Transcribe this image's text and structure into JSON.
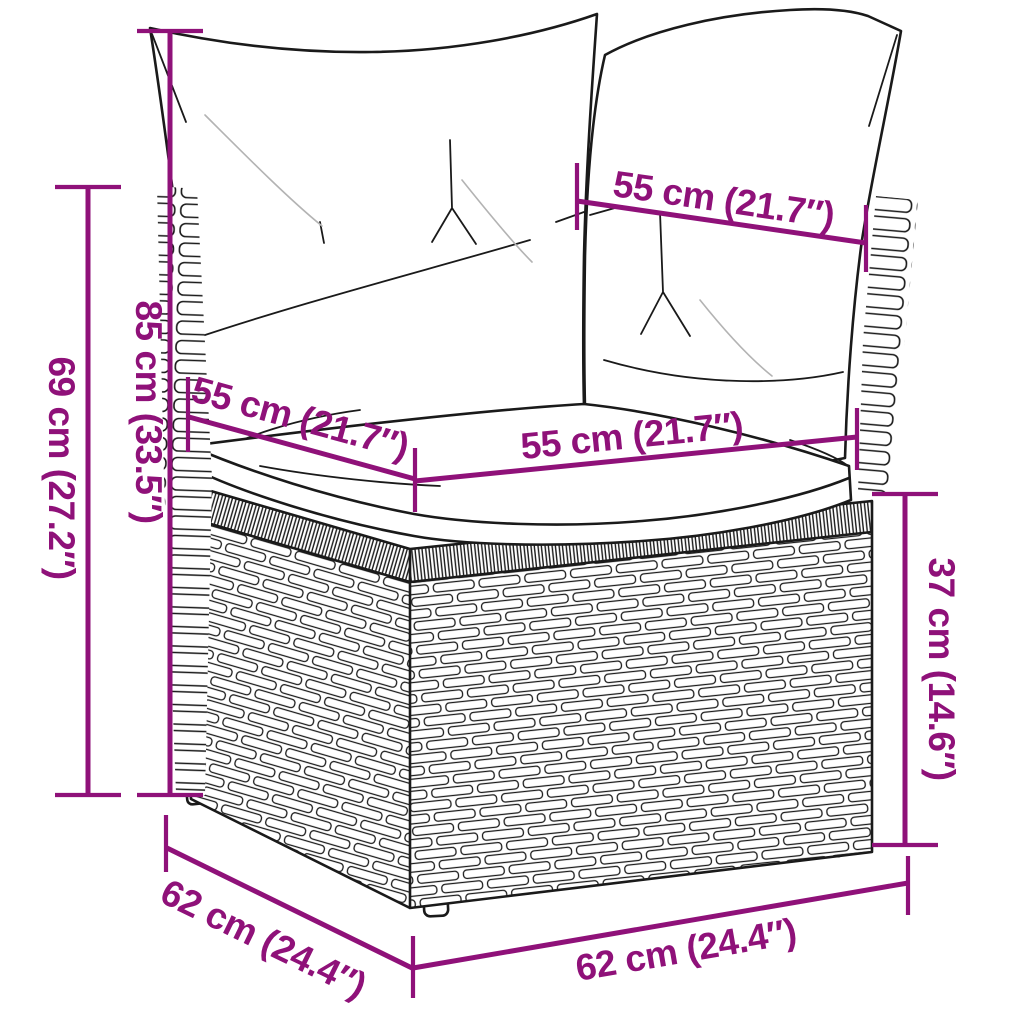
{
  "diagram": {
    "title": "Corner sofa section dimension diagram",
    "product": "Poly rattan garden corner sofa section with cushions",
    "background_color": "#ffffff",
    "line_art_color": "#1a1a1a",
    "dimension_color": "#8F1179",
    "dimensions": [
      {
        "name": "total-back-height",
        "label": "85 cm (33.5″)",
        "orientation": "vertical"
      },
      {
        "name": "frame-back-height",
        "label": "69 cm (27.2″)",
        "orientation": "vertical"
      },
      {
        "name": "back-cushion-width",
        "label": "55 cm (21.7″)",
        "orientation": "diagonal"
      },
      {
        "name": "seat-depth",
        "label": "55 cm (21.7″)",
        "orientation": "diagonal"
      },
      {
        "name": "seat-width",
        "label": "55 cm (21.7″)",
        "orientation": "horizontal"
      },
      {
        "name": "base-height",
        "label": "37 cm (14.6″)",
        "orientation": "vertical"
      },
      {
        "name": "base-depth",
        "label": "62 cm (24.4″)",
        "orientation": "diagonal"
      },
      {
        "name": "base-width",
        "label": "62 cm (24.4″)",
        "orientation": "horizontal"
      }
    ]
  }
}
